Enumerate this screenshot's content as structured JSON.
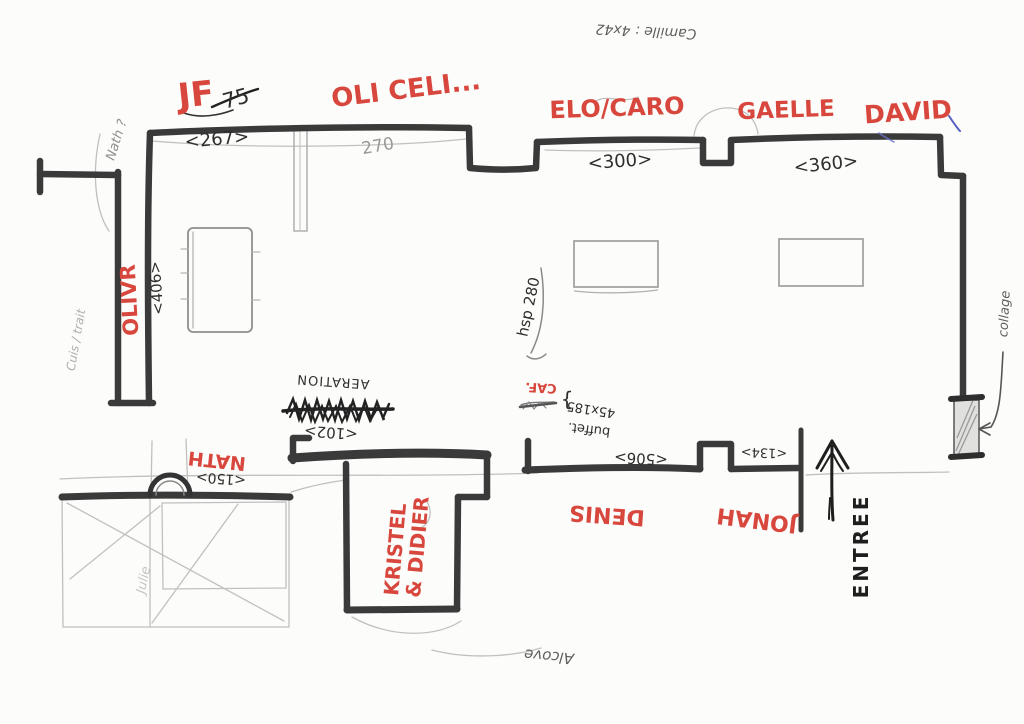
{
  "colors": {
    "red_marker": "#d8473d",
    "wall": "#3a3a3a",
    "pencil": "#9b9b9b",
    "ink": "#2e2e2e",
    "blue_pen": "#5560c4",
    "paper": "#fcfcfa"
  },
  "names": {
    "jf": "JF",
    "jf_note": "75",
    "oli_celi": "OLI CELI...",
    "elo_caro": "ELO/CARO",
    "gaelle": "GAELLE",
    "david": "DAVID",
    "olivr": "OLIVR",
    "nath": "NATH",
    "kristel_line1": "KRISTEL",
    "kristel_line2": "& DIDIER",
    "denis": "DENIS",
    "jonah": "JONAH",
    "nath_question": "Nath ?",
    "julie": "Julie",
    "camille_note": "Camille : 4x42"
  },
  "dimensions": {
    "wall_jf": "<267>",
    "wall_oli": "270",
    "wall_elo": "<300>",
    "wall_gaelle": "<360>",
    "corridor": "<406>",
    "aeration_wall": "<102>",
    "nath_wall": "<150>",
    "denis_wall": "<506>",
    "entry_wall": "<134>",
    "buffet_size": "45x185",
    "ceiling_height": "hsp 280"
  },
  "labels": {
    "entrance": "ENTREE",
    "aeration": "AERATION",
    "cafe": "CAF.",
    "buffet": "buffet.",
    "buffet_brace": "}",
    "alcove": "Alcove",
    "collage": "collage",
    "corridor_note": "Cuis / trait"
  }
}
